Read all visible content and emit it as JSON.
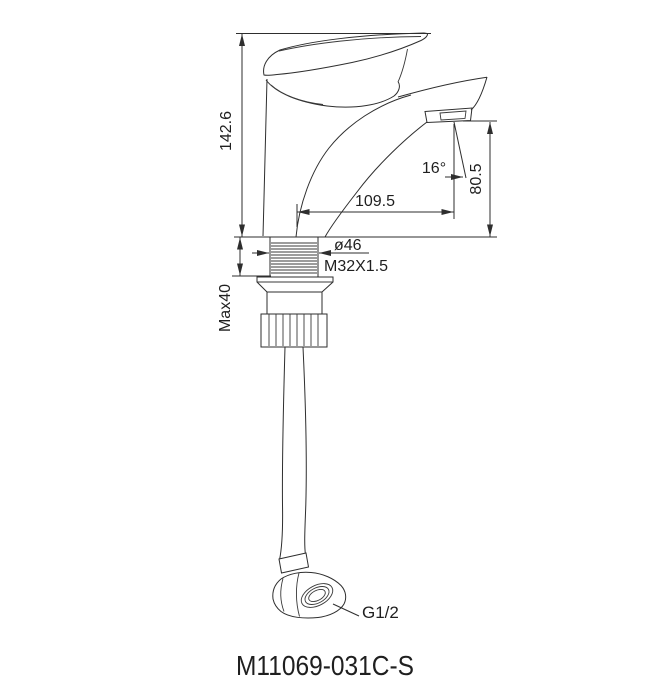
{
  "drawing": {
    "product_code": "M11069-031C-S",
    "dims": {
      "overall_height": "142.6",
      "max_mounting_thickness": "Max40",
      "spout_reach": "109.5",
      "outlet_height": "80.5",
      "outlet_angle": "16°",
      "flange_diameter": "ø46",
      "mounting_thread": "M32X1.5",
      "hose_thread": "G1/2"
    },
    "colors": {
      "line": "#2e2e2e",
      "text": "#1f1f1f",
      "background": "#ffffff"
    }
  }
}
